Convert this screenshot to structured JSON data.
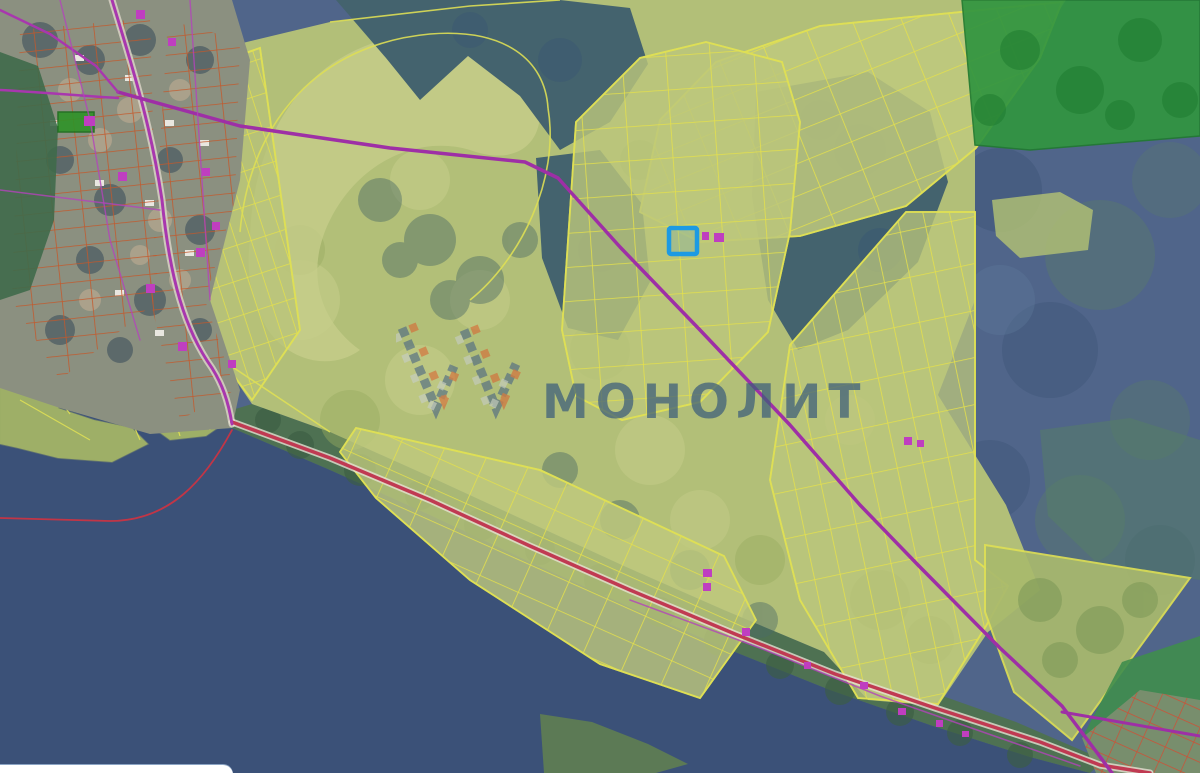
{
  "watermark": {
    "text": "МОНОЛИТ"
  },
  "map": {
    "kind": "cadastral-satellite-map",
    "selected_parcel": {
      "outline_color": "#1d9ae3"
    },
    "colors": {
      "water": "#3b5178",
      "forest_blue": "#50658a",
      "forest_teal": "#44636e",
      "forest_green_bright": "#319540",
      "field": "#b2bf78",
      "field_light": "#c7cf8c",
      "shore_green": "#4e7152",
      "parcel_line_yellow": "#e4e04c",
      "parcel_line_orange": "#c4582a",
      "road_magenta": "#9e2fa6",
      "road_red": "#c03a52",
      "building_pink": "#bf3ec0",
      "watermark_color": "#3c5d7b"
    }
  },
  "ui": {
    "bottom_left_panel": {
      "type": "rounded-white-panel"
    }
  }
}
